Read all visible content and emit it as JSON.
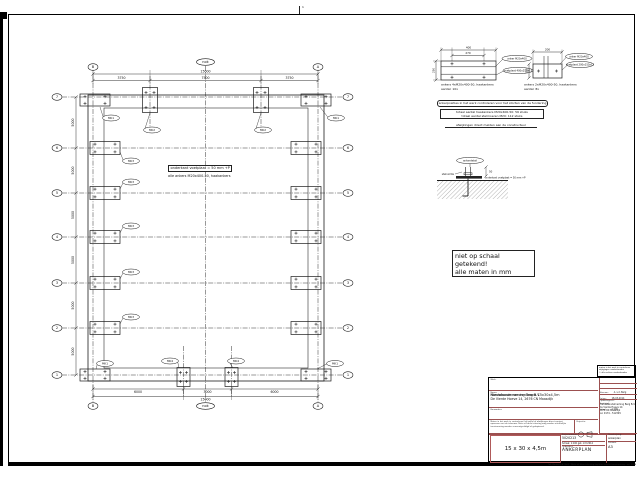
{
  "sheet": {
    "fold_mark": "1"
  },
  "plan": {
    "grid": {
      "row_labels": [
        "7",
        "6",
        "5",
        "4",
        "3",
        "2",
        "1"
      ],
      "left_col": "B",
      "right_col": "A",
      "ridge": "nok"
    },
    "dims": {
      "top_total": "15000",
      "top_segments": [
        "3750",
        "7500",
        "3750"
      ],
      "bottom_segments": [
        "6000",
        "3000",
        "6000"
      ],
      "bottom_total": "15000",
      "left_segments": [
        "5000",
        "5000",
        "5000",
        "5000",
        "5000",
        "5000"
      ]
    },
    "callouts": {
      "corner": "MK1",
      "gable": "MK2",
      "side": "MK3",
      "door": "MK4"
    },
    "notes": {
      "line1": "onderkant voetplaat = 50 mm +P",
      "line2": "alle ankers M20x400-50, haakankers"
    }
  },
  "details": {
    "plate4": {
      "dim_top": "400",
      "dim_inner": "270",
      "dim_left": "250",
      "callout1": "anker M20x400",
      "callout2": "voetplaat 400x250x15",
      "caption1": "ankers 4xM20x400-50, haakankers",
      "caption2": "aantal: 10x"
    },
    "plate2": {
      "dim_top": "200",
      "dim_left": "150",
      "callout1": "anker M20x400",
      "callout2": "voetplaat 200x150x12",
      "caption1": "ankers 2xM20x400-50, haakankers",
      "caption2": "aantal: 8x"
    },
    "ground": {
      "label": "ankerdetail",
      "dim": "50",
      "note_left": "stelruimte",
      "note_right": "onderkant voetplaat = 50 mm +P"
    }
  },
  "notes": {
    "rounded": "ankerposities in het werk controleren voor het storten van de fundering",
    "boxed1": "totaal aantal haakankers M20x400-50: 56 stuks",
    "boxed2": "totaal aantal stelmoeren M20: 112 stuks",
    "underlined": "afwijkingen direct melden aan de constructeur",
    "scale1": "niet op schaal getekend!",
    "scale2": "alle maten in mm"
  },
  "titleblock": {
    "werk_label": "Werk:",
    "werk": "Nieuwbouw van een loods 15x30x4,5m",
    "naam_label": "Naam:",
    "naam1": "Handelsonderneming Berg B.V.",
    "naam2": "De Vierde Hoeve 14, 2676 CN Maasdijk",
    "bouwadres_label": "Bouwadres:",
    "bouwadres": "",
    "disclaimer1": "Maten in het werk te controleren; bij twijfel of afwijkingen direct contact opnemen met de tekenaar.",
    "disclaimer2": "Niets uit deze tekening mag zonder schriftelijke toestemming worden vermenigvuldigd of gekopieerd.",
    "projectie_label": "Projectie:",
    "size_box": "15 x 30 x 4,5m",
    "projectnr_label": "Projectnummer:",
    "projectnr": "5020213",
    "schaal_label": "Schaal:",
    "schaal": "1:100",
    "get_note": "get. mrt 2014",
    "onderdeel_label": "Onderdeel:",
    "onderdeel": "ANKERPLAN",
    "omschrijving_label": "Omschrijving:",
    "omschrijving": "ankerplan",
    "formaat_label": "Formaat",
    "formaat": "A3",
    "mini_note1": "maten in het werk te controleren",
    "mini_note2": "wijzigingen voorbehouden",
    "mini_note3": "© alle rechten voorbehouden",
    "right_rows": [
      {
        "label": "Tekenaar:",
        "value": "A. v.d. Berg"
      },
      {
        "label": "Datum:",
        "value": "18-03-2014"
      },
      {
        "label": "Gewijzigd:",
        "value": "-"
      },
      {
        "label": "Schaal:",
        "value": "1:100"
      }
    ],
    "opdrachtgever_label": "Opdrachtgever:",
    "opdrachtgever": [
      "Handelsonderneming Berg B.V.",
      "De Vierde Hoeve 14",
      "2676 CN Maasdijk",
      "tel. 0174 - 512345"
    ],
    "footer": "Tek. Bureau v.d. Stelt · Niets uit deze tekening kopiëren zonder toestemming · mrt 2014"
  }
}
